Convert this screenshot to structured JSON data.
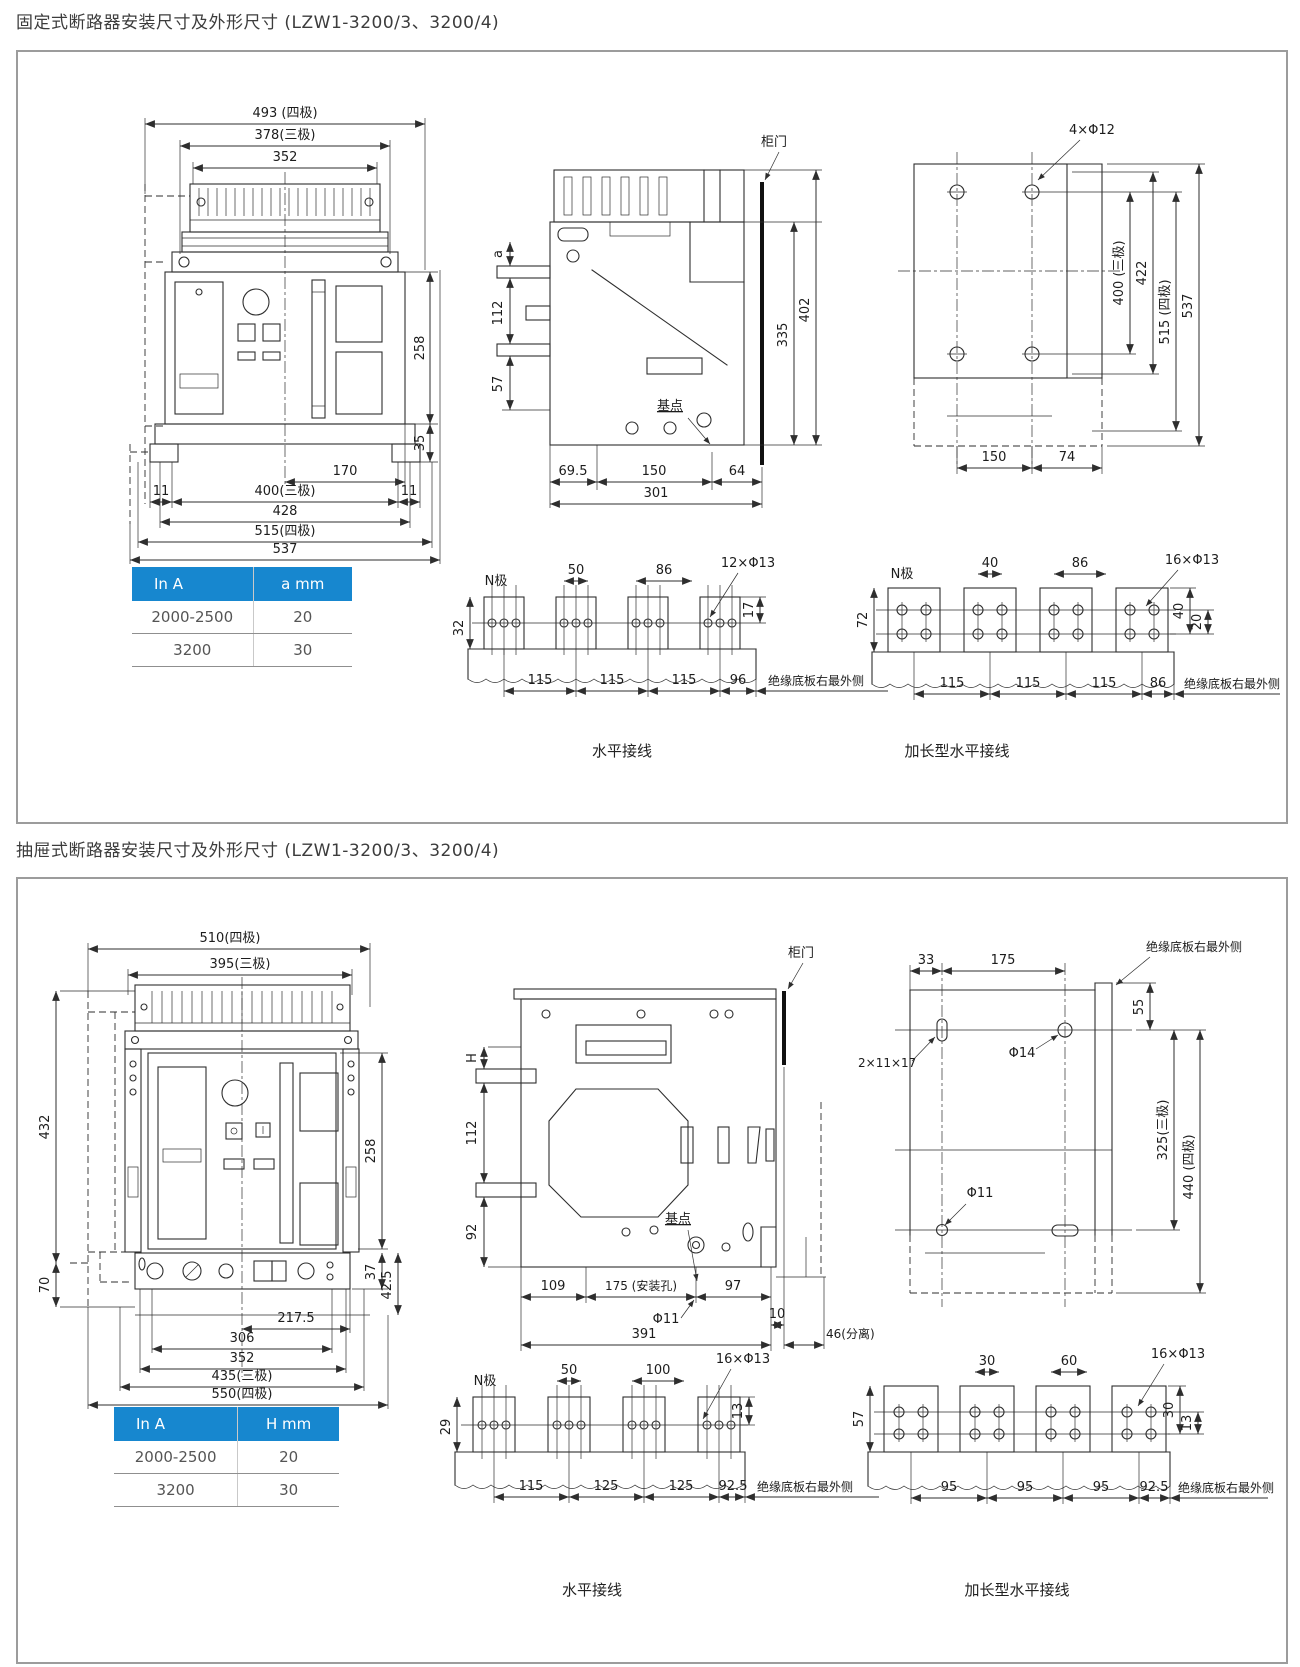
{
  "accent": "#1787cf",
  "s1": {
    "title": "固定式断路器安装尺寸及外形尺寸 (LZW1-3200/3、3200/4)",
    "front": {
      "d493": "493 (四极)",
      "d378": "378(三极)",
      "d352": "352",
      "d258": "258",
      "d35": "35",
      "d170": "170",
      "d11l": "11",
      "d11r": "11",
      "d400": "400(三极)",
      "d428": "428",
      "d515": "515(四极)",
      "d537": "537"
    },
    "side": {
      "door": "柜门",
      "da": "a",
      "d112": "112",
      "d57": "57",
      "base": "基点",
      "d695": "69.5",
      "d150": "150",
      "d64": "64",
      "d301": "301",
      "d335": "335",
      "d402": "402"
    },
    "holes": {
      "holes": "4×Φ12",
      "d400": "400 (三极)",
      "d422": "422",
      "d515": "515 (四极)",
      "d537": "537",
      "d150": "150",
      "d74": "74"
    },
    "table": {
      "h1": "In  A",
      "h2": "a mm",
      "r1c1": "2000-2500",
      "r1c2": "20",
      "r2c1": "3200",
      "r2c2": "30"
    },
    "hz": {
      "n": "N极",
      "d50": "50",
      "d86": "86",
      "holes": "12×Φ13",
      "d17": "17",
      "d32": "32",
      "b1": "115",
      "b2": "115",
      "b3": "115",
      "b4": "96",
      "edge": "绝缘底板右最外侧",
      "caption": "水平接线"
    },
    "ext": {
      "n": "N极",
      "d40": "40",
      "d86": "86",
      "holes": "16×Φ13",
      "d40v": "40",
      "d20": "20",
      "d72": "72",
      "b1": "115",
      "b2": "115",
      "b3": "115",
      "b4": "86",
      "edge": "绝缘底板右最外侧",
      "caption": "加长型水平接线"
    }
  },
  "s2": {
    "title": "抽屉式断路器安装尺寸及外形尺寸 (LZW1-3200/3、3200/4)",
    "front": {
      "d510": "510(四极)",
      "d395": "395(三极)",
      "d432": "432",
      "d70": "70",
      "d258": "258",
      "d37": "37",
      "d425": "42.5",
      "d2175": "217.5",
      "d306": "306",
      "d352": "352",
      "d435": "435(三极)",
      "d550": "550(四极)"
    },
    "side": {
      "door": "柜门",
      "dH": "H",
      "d112": "112",
      "d92": "92",
      "base": "基点",
      "d109": "109",
      "d175": "175 (安装孔)",
      "d97": "97",
      "dphi11": "Φ11",
      "d10": "10",
      "d391": "391",
      "d46": "46(分离)"
    },
    "holes": {
      "edge": "绝缘底板右最外侧",
      "d33": "33",
      "d175": "175",
      "d55": "55",
      "slot": "2×11×17",
      "dphi14": "Φ14",
      "dphi11": "Φ11",
      "d325": "325(三极)",
      "d440": "440 (四极)"
    },
    "table": {
      "h1": "In  A",
      "h2": "H mm",
      "r1c1": "2000-2500",
      "r1c2": "20",
      "r2c1": "3200",
      "r2c2": "30"
    },
    "hz": {
      "n": "N极",
      "d50": "50",
      "d100": "100",
      "holes": "16×Φ13",
      "d13": "13",
      "d29": "29",
      "b1": "115",
      "b2": "125",
      "b3": "125",
      "b4": "92.5",
      "edge": "绝缘底板右最外侧",
      "caption": "水平接线"
    },
    "ext": {
      "d30": "30",
      "d60": "60",
      "holes": "16×Φ13",
      "d30v": "30",
      "d13": "13",
      "d57": "57",
      "b1": "95",
      "b2": "95",
      "b3": "95",
      "b4": "92.5",
      "edge": "绝缘底板右最外侧",
      "caption": "加长型水平接线"
    }
  }
}
